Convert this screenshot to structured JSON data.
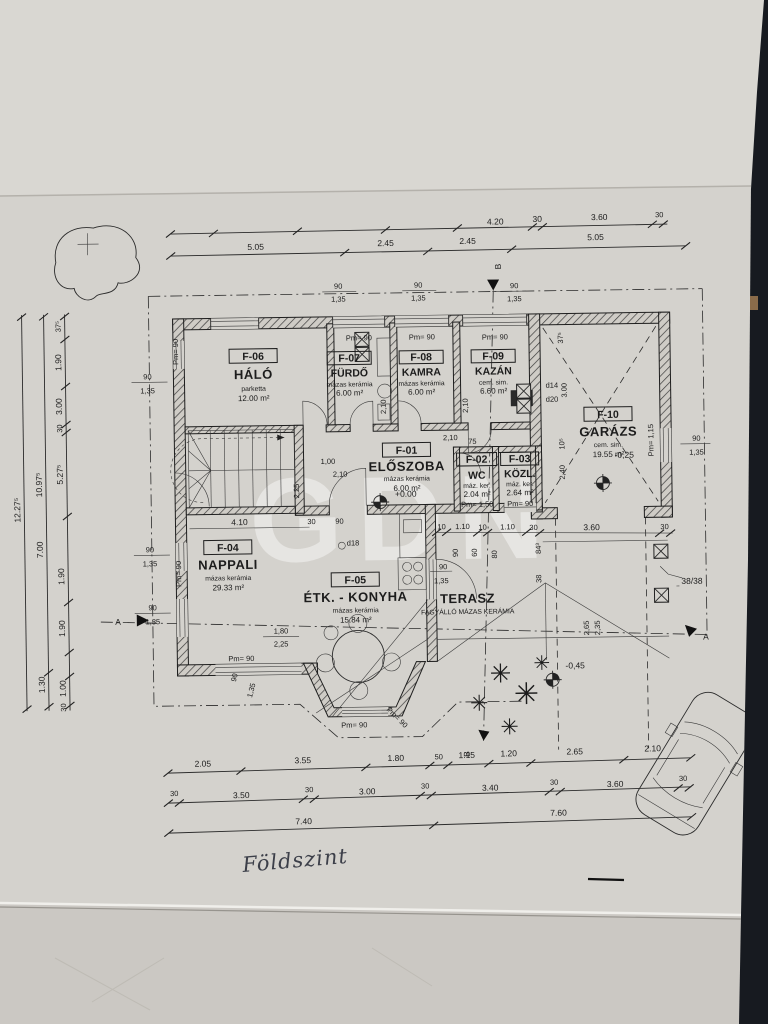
{
  "plan": {
    "watermark": "GDN",
    "handwriting": "Földszint",
    "pillar_note": "38/38",
    "sections": {
      "a": "A",
      "b": "B"
    },
    "levels": {
      "entry": "+0.00",
      "garage": "-0,25",
      "yard": "-0,45"
    },
    "pm": {
      "p90": "Pm= 90",
      "p115": "Pm= 1,15",
      "p150": "Pm= 1,50"
    },
    "terrace": {
      "name": "TERASZ",
      "finish": "FAGYÁLLÓ MÁZAS KERÁMIA"
    },
    "rooms": [
      {
        "id": "F-01",
        "name": "ELŐSZOBA",
        "finish": "mázas kerámia",
        "area": "6.00 m²"
      },
      {
        "id": "F-02",
        "name": "WC",
        "finish": "máz. ker.",
        "area": "2.04 m²"
      },
      {
        "id": "F-03",
        "name": "KÖZL.",
        "finish": "máz. ker.",
        "area": "2.64 m²"
      },
      {
        "id": "F-04",
        "name": "NAPPALI",
        "finish": "mázas kerámia",
        "area": "29.33 m²"
      },
      {
        "id": "F-05",
        "name": "ÉTK. - KONYHA",
        "finish": "mázas kerámia",
        "area": "15.84 m²"
      },
      {
        "id": "F-06",
        "name": "HÁLÓ",
        "finish": "parketta",
        "area": "12.00 m²"
      },
      {
        "id": "F-07",
        "name": "FÜRDŐ",
        "finish": "mázas kerámia",
        "area": "6.00 m²"
      },
      {
        "id": "F-08",
        "name": "KAMRA",
        "finish": "mázas kerámia",
        "area": "6.00 m²"
      },
      {
        "id": "F-09",
        "name": "KAZÁN",
        "finish": "cem. sim.",
        "area": "6.60 m²"
      },
      {
        "id": "F-10",
        "name": "GARÁZS",
        "finish": "cem. sim.",
        "area": "19.55 m²"
      }
    ],
    "dims": {
      "top1": {
        "a": "4.20",
        "b": "30",
        "c": "3.60",
        "d": "30"
      },
      "top2": {
        "a": "5.05",
        "b": "2.45",
        "c": "2.45",
        "d": "5.05"
      },
      "sill": {
        "a": "90",
        "b": "1,35"
      },
      "left": {
        "outer": "12.27⁵",
        "mid": "10.97⁵",
        "seg375": "37⁵",
        "seg190": "1.90",
        "seg300": "3.00",
        "seg30": "30",
        "seg527": "5.27⁵",
        "seg700": "7.00",
        "seg130": "1.30",
        "seg100": "1.00"
      },
      "bottom1": {
        "a": "2.05",
        "b": "3.55",
        "c": "1.80",
        "d": "50",
        "e": "1.15",
        "f": "1.20",
        "g": "2.65",
        "h": "2.10"
      },
      "bottom2": {
        "a": "30",
        "b": "3.50",
        "c": "3.00",
        "d": "3.40",
        "e": "3.60"
      },
      "bottom3": {
        "a": "7.40",
        "b": "7.60"
      },
      "misc": {
        "v410": "4.10",
        "v90": "90",
        "v30": "30",
        "v75": "75",
        "v210": "2,10",
        "v100": "1,00",
        "v225": "2,25",
        "v180": "1,80",
        "d18": "d18",
        "d14": "d14",
        "d20": "d20",
        "v300": "3.00",
        "v240": "2,40",
        "v375": "37⁵",
        "v105": "10⁵",
        "v360": "3.60",
        "v10": "10",
        "v110": "1.10",
        "v843": "84³",
        "v38": "38",
        "v265": "2,65",
        "v235": "2,35",
        "v60": "60",
        "v80": "80"
      }
    }
  }
}
